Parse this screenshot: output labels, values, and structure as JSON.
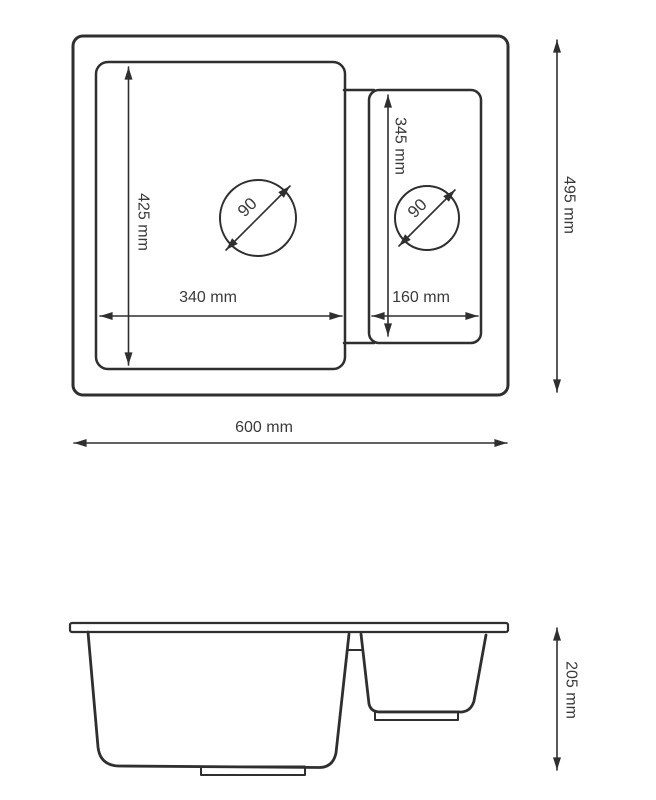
{
  "drawing": {
    "subject": "double-bowl kitchen sink technical drawing",
    "colors": {
      "line": "#2f2f2f",
      "text": "#3a3a3a",
      "background": "#ffffff"
    },
    "top_view": {
      "overall": {
        "width_label": "600 mm",
        "depth_label": "495 mm"
      },
      "main_bowl": {
        "inner_width_label": "340 mm",
        "inner_depth_label": "425 mm",
        "drain_diameter_label": "90"
      },
      "small_bowl": {
        "inner_width_label": "160 mm",
        "inner_depth_label": "345 mm",
        "drain_diameter_label": "90"
      }
    },
    "side_view": {
      "height_label": "205 mm"
    }
  }
}
